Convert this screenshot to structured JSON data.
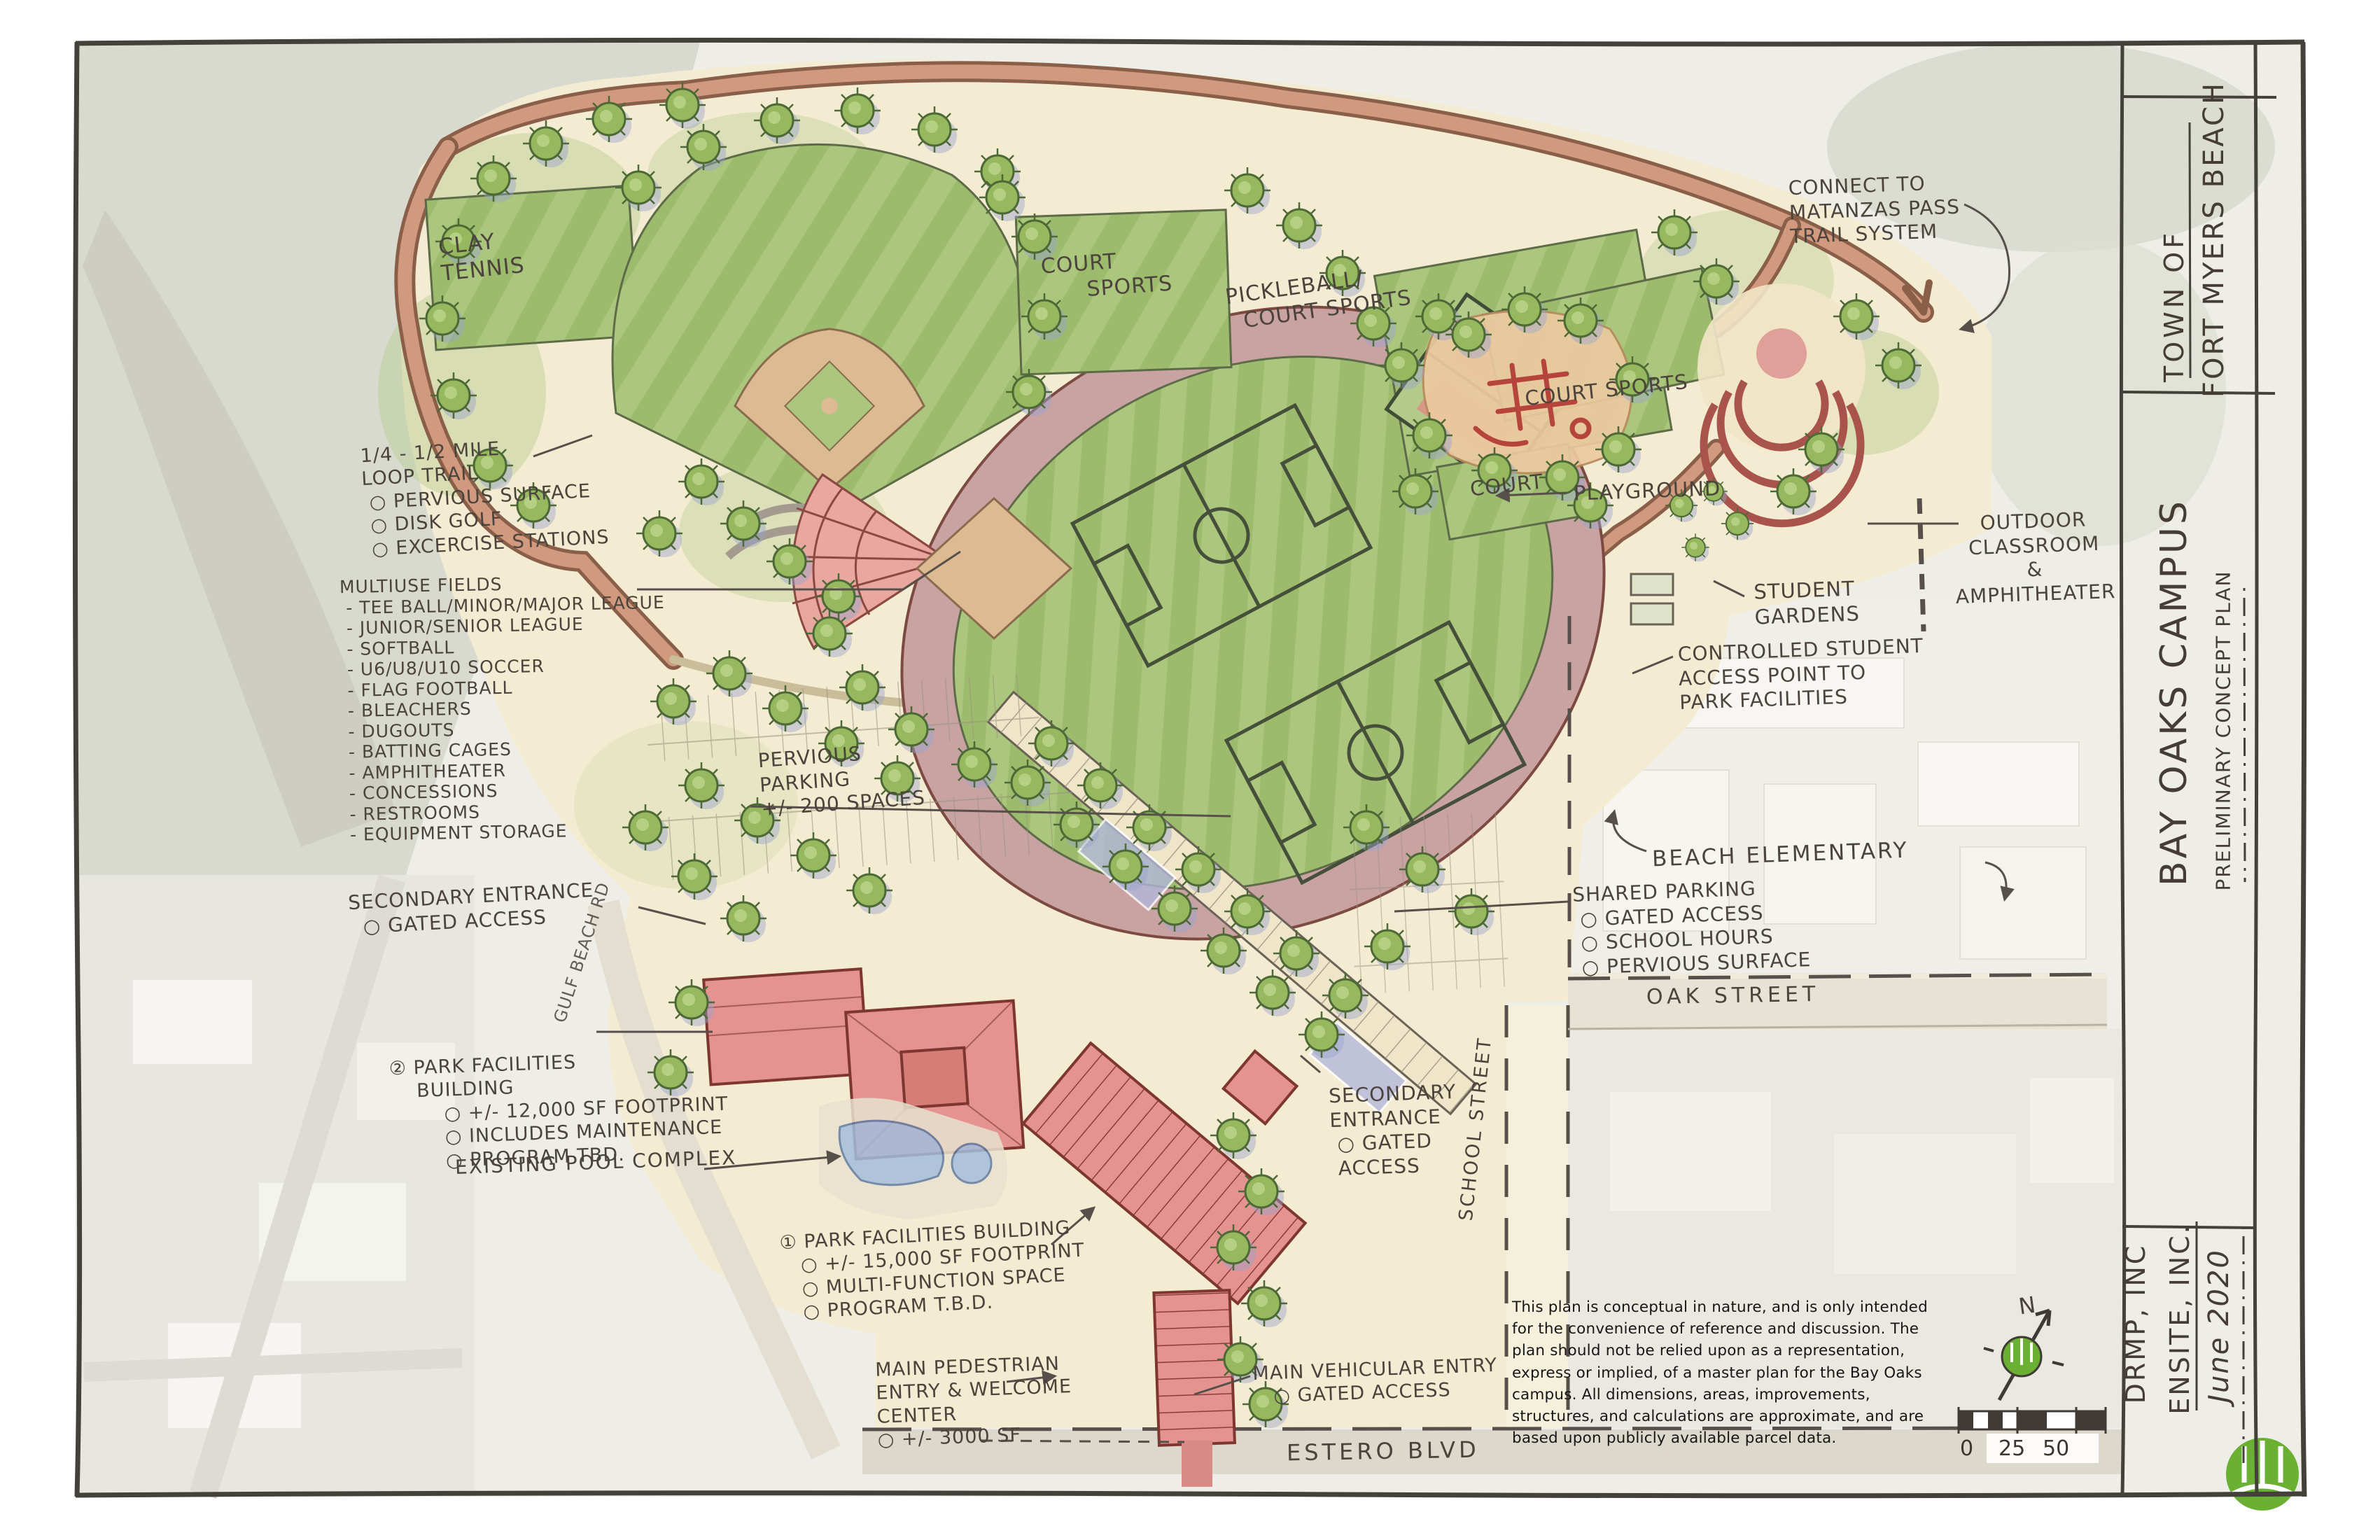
{
  "sheet": {
    "title_block": {
      "town_line1": "TOWN OF",
      "town_line2": "FORT MYERS BEACH",
      "project_title": "BAY OAKS CAMPUS",
      "project_subtitle": "PRELIMINARY CONCEPT PLAN",
      "consultant_1": "DRMP, INC",
      "consultant_2": "ENSITE, INC.",
      "date": "June 2020"
    },
    "north": {
      "label": "N"
    },
    "scale_bar": {
      "tick_labels": [
        "0",
        "25",
        "50"
      ]
    },
    "colors": {
      "logo_green": "#6ab033",
      "field_green": "#abc77e",
      "building_red": "#e49390",
      "trail_salmon": "#c98f74",
      "ink": "#4b433c"
    }
  },
  "annotations": {
    "connect_trail": "CONNECT TO\nMATANZAS PASS\nTRAIL SYSTEM",
    "clay_tennis": "CLAY\nTENNIS",
    "court_sports_top": "COURT\n      SPORTS",
    "pickleball": "PICKLEBALL/\n  COURT SPORTS",
    "court_sports_right": "COURT SPORTS",
    "playground": "PLAYGROUND",
    "court_small": "COURT",
    "outdoor_classroom": "OUTDOOR\nCLASSROOM\n&\nAMPHITHEATER",
    "student_gardens": "STUDENT\nGARDENS",
    "controlled_access": "CONTROLLED STUDENT\nACCESS POINT TO\nPARK FACILITIES",
    "loop_trail": "1/4 - 1/2 MILE\nLOOP TRAIL\n ○ PERVIOUS SURFACE\n ○ DISK GOLF\n ○ EXCERCISE STATIONS",
    "multiuse_fields": "MULTIUSE FIELDS\n - TEE BALL/MINOR/MAJOR LEAGUE\n - JUNIOR/SENIOR LEAGUE\n - SOFTBALL\n - U6/U8/U10 SOCCER\n - FLAG FOOTBALL\n - BLEACHERS\n - DUGOUTS\n - BATTING CAGES\n - AMPHITHEATER\n - CONCESSIONS\n - RESTROOMS\n - EQUIPMENT STORAGE",
    "pervious_parking": "PERVIOUS\nPARKING\n+/- 200 SPACES",
    "secondary_entrance_west": "SECONDARY ENTRANCE\n  ○ GATED ACCESS",
    "park_facilities_bldg_2": "② PARK FACILITIES\n    BUILDING\n        ○ +/- 12,000 SF FOOTPRINT\n        ○ INCLUDES MAINTENANCE\n        ○ PROGRAM TBD.",
    "existing_pool": "EXISTING POOL COMPLEX",
    "park_facilities_bldg_1": "① PARK FACILITIES BUILDING\n   ○ +/- 15,000 SF FOOTPRINT\n   ○ MULTI-FUNCTION SPACE\n   ○ PROGRAM T.B.D.",
    "main_pedestrian": "MAIN PEDESTRIAN\nENTRY & WELCOME\nCENTER\n○ +/- 3000 SF",
    "main_vehicular": "MAIN VEHICULAR ENTRY\n   ○ GATED ACCESS",
    "secondary_entrance_school": "SECONDARY\nENTRANCE\n ○ GATED\n ACCESS",
    "shared_parking": "SHARED PARKING\n ○ GATED ACCESS\n ○ SCHOOL HOURS\n ○ PERVIOUS SURFACE",
    "beach_elementary": "BEACH ELEMENTARY",
    "streets": {
      "oak": "OAK STREET",
      "school": "SCHOOL STREET",
      "estero": "ESTERO BLVD",
      "gulf_beach": "GULF BEACH RD"
    },
    "disclaimer": "This plan is conceptual in nature, and is only intended for the convenience of reference and discussion.  The plan should not be relied upon as a representation, express or implied, of a master plan for the Bay Oaks campus. All dimensions, areas, improvements, structures, and calculations are approximate, and are based upon publicly available parcel data."
  }
}
